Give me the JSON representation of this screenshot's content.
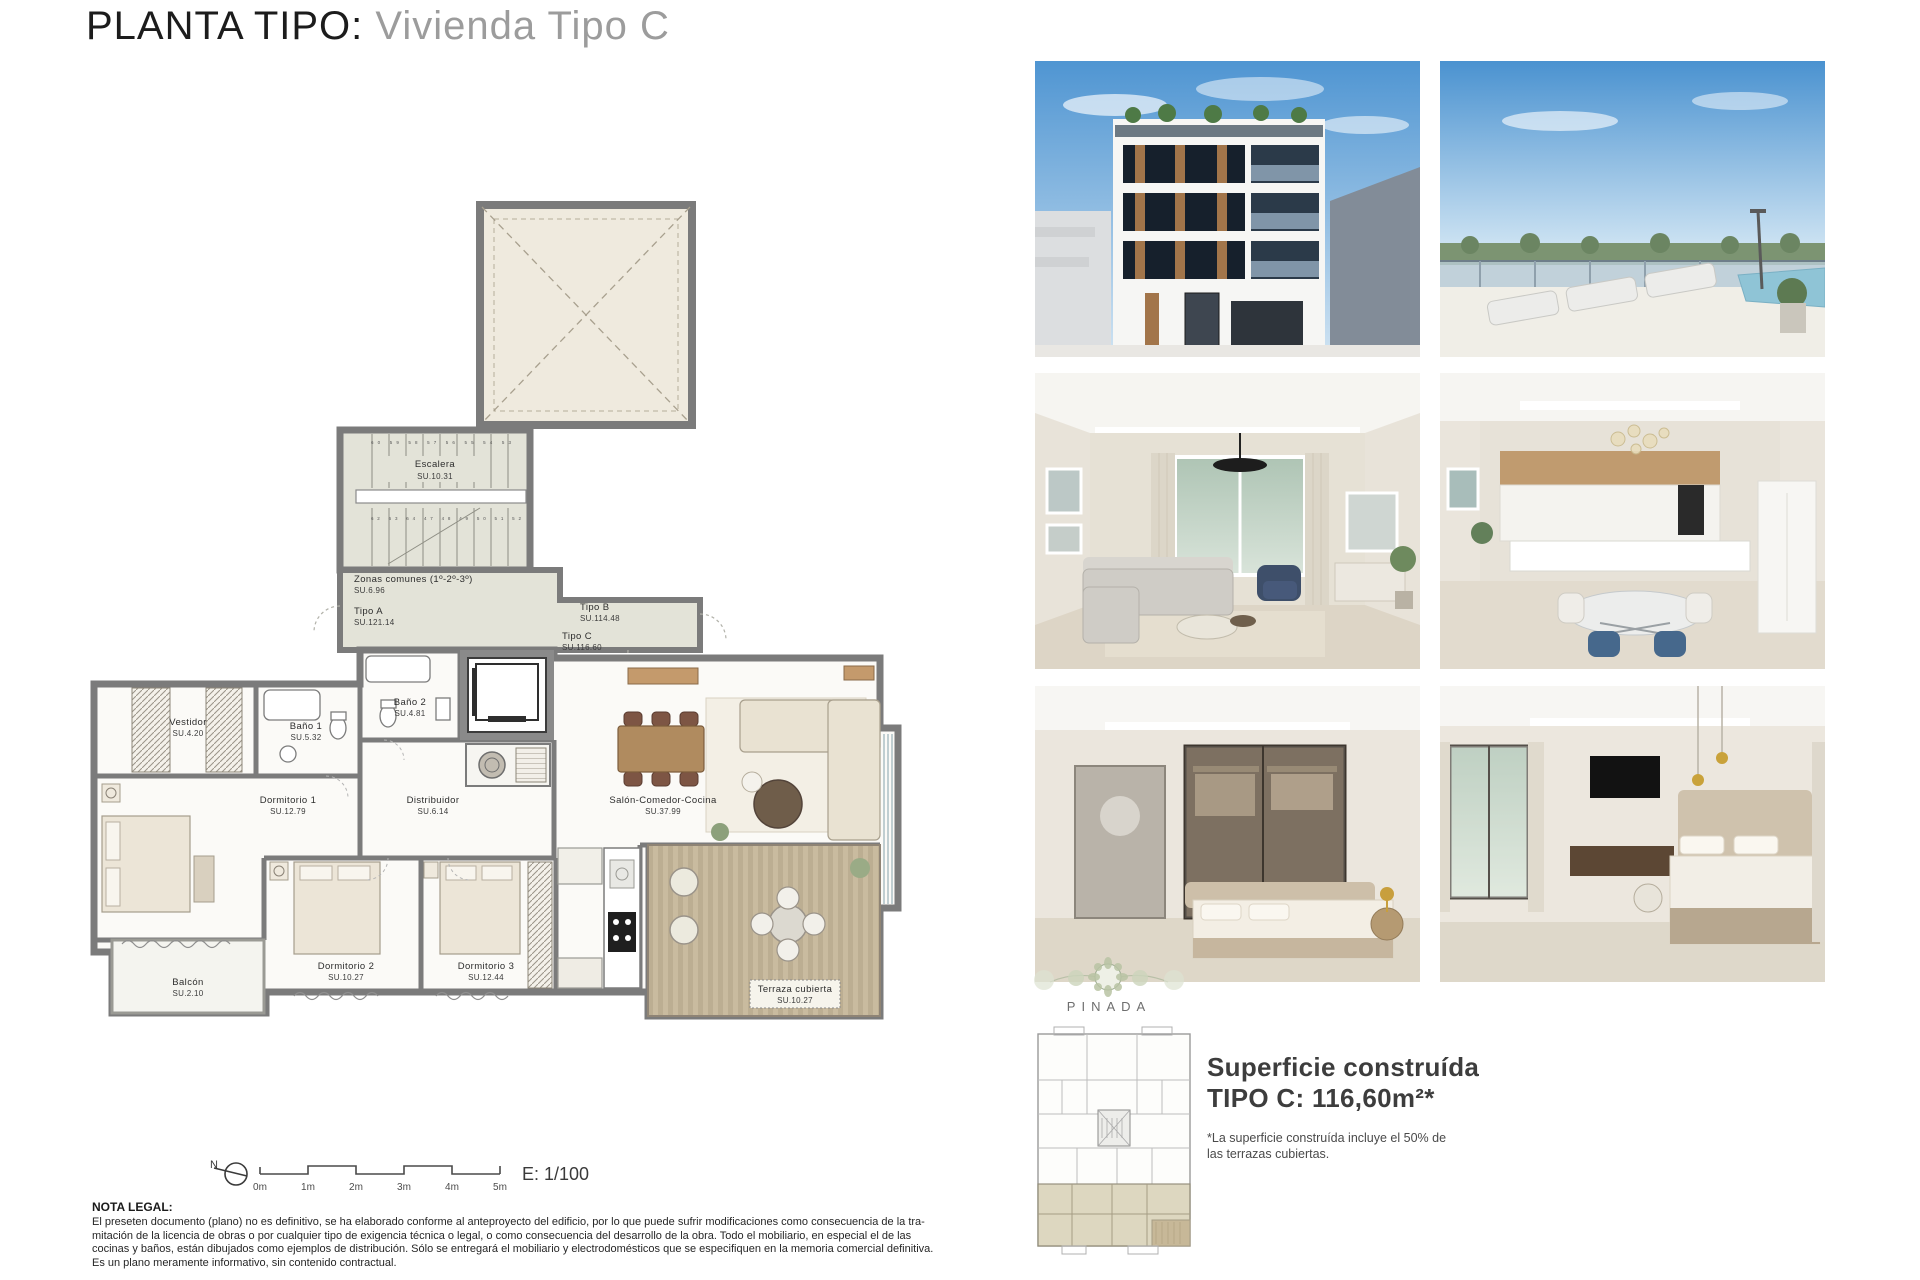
{
  "title": {
    "main": "PLANTA TIPO:",
    "sub": " Vivienda Tipo C"
  },
  "plan": {
    "rooms": {
      "escalera": {
        "name": "Escalera",
        "area": "SU.10.31"
      },
      "zonas": {
        "name": "Zonas comunes (1º-2º-3º)",
        "area": "SU.6.96"
      },
      "tipoA": {
        "name": "Tipo A",
        "area": "SU.121.14"
      },
      "tipoB": {
        "name": "Tipo B",
        "area": "SU.114.48"
      },
      "tipoC": {
        "name": "Tipo C",
        "area": "SU.116.60"
      },
      "vestidor": {
        "name": "Vestidor",
        "area": "SU.4.20"
      },
      "bano1": {
        "name": "Baño 1",
        "area": "SU.5.32"
      },
      "bano2": {
        "name": "Baño 2",
        "area": "SU.4.81"
      },
      "dorm1": {
        "name": "Dormitorio 1",
        "area": "SU.12.79"
      },
      "distribuidor": {
        "name": "Distribuidor",
        "area": "SU.6.14"
      },
      "salon": {
        "name": "Salón-Comedor-Cocina",
        "area": "SU.37.99"
      },
      "dorm2": {
        "name": "Dormitorio 2",
        "area": "SU.10.27"
      },
      "dorm3": {
        "name": "Dormitorio 3",
        "area": "SU.12.44"
      },
      "balcon": {
        "name": "Balcón",
        "area": "SU.2.10"
      },
      "terraza": {
        "name": "Terraza cubierta",
        "area": "SU.10.27"
      }
    },
    "stairs": {
      "top_numbers": "60 59 58 57 56 55 54 53",
      "bottom_numbers": "62 63 64 47 48 49 50 51 52"
    },
    "scale": {
      "ticks": [
        "0m",
        "1m",
        "2m",
        "3m",
        "4m",
        "5m"
      ],
      "ratio": "E: 1/100",
      "north_label": "N"
    }
  },
  "brand": {
    "name": "PINADA"
  },
  "summary": {
    "line1": "Superficie construída",
    "line2": "TIPO C: 116,60m²*",
    "note_line1": "*La superficie construída incluye el 50% de",
    "note_line2": "las  terrazas cubiertas."
  },
  "legal": {
    "heading": "NOTA LEGAL:",
    "lines": [
      "El preseten documento (plano) no es definitivo, se ha elaborado conforme al anteproyecto del edificio, por lo que puede sufrir modificaciones como consecuencia de la tra-",
      "mitación de la licencia de obras o por cualquier tipo de exigencia técnica o legal, o como consecuencia del desarrollo de la obra. Todo el mobiliario, en especial el de las",
      "cocinas y baños, están dibujados como ejemplos de distribución. Sólo se entregará el mobiliario y electrodomésticos que se especifiquen en la memoria comercial definitiva.",
      "Es un plano meramente informativo, sin contenido contractual."
    ]
  },
  "colors": {
    "wall_gray": "#7b7b7b",
    "common_fill": "#e3e3d8",
    "patio_fill": "#eeeade",
    "deck": "#c9bb9f",
    "highlight_unit": "#d8d1b6",
    "sky": "#5f9fd8",
    "wood": "#b08b5f"
  }
}
